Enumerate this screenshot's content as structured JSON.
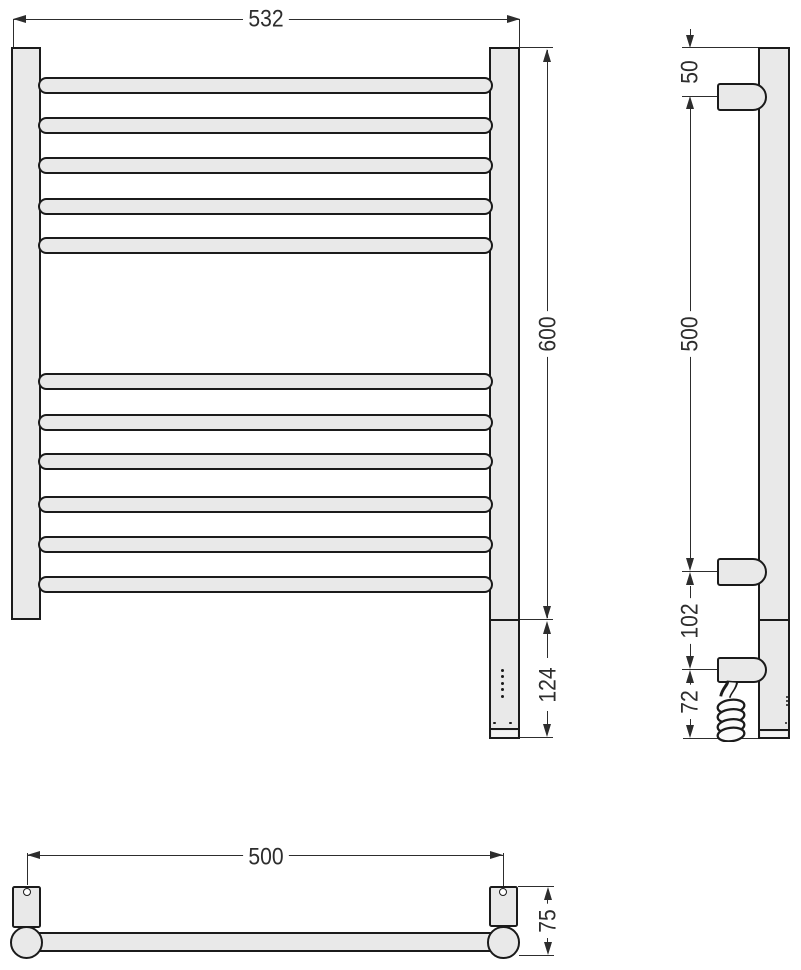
{
  "drawing": {
    "type": "technical-drawing",
    "subject": "heated towel rail ladder radiator - three orthographic views with dimensions",
    "colors": {
      "fill": "#e9e9e9",
      "outline": "#1b1b1b",
      "dimension": "#2d2d2d",
      "background": "#ffffff"
    },
    "views": {
      "front": {
        "dim_width": "532",
        "dim_height": "600",
        "dim_bottom_section": "124",
        "rungs_top_group": "5",
        "rungs_bottom_group": "6"
      },
      "side": {
        "dim_top_offset": "50",
        "dim_bracket_span": "500",
        "dim_mid_section": "102",
        "dim_lower_section": "72"
      },
      "bottom": {
        "dim_mount_span": "500",
        "dim_depth": "75"
      }
    }
  }
}
